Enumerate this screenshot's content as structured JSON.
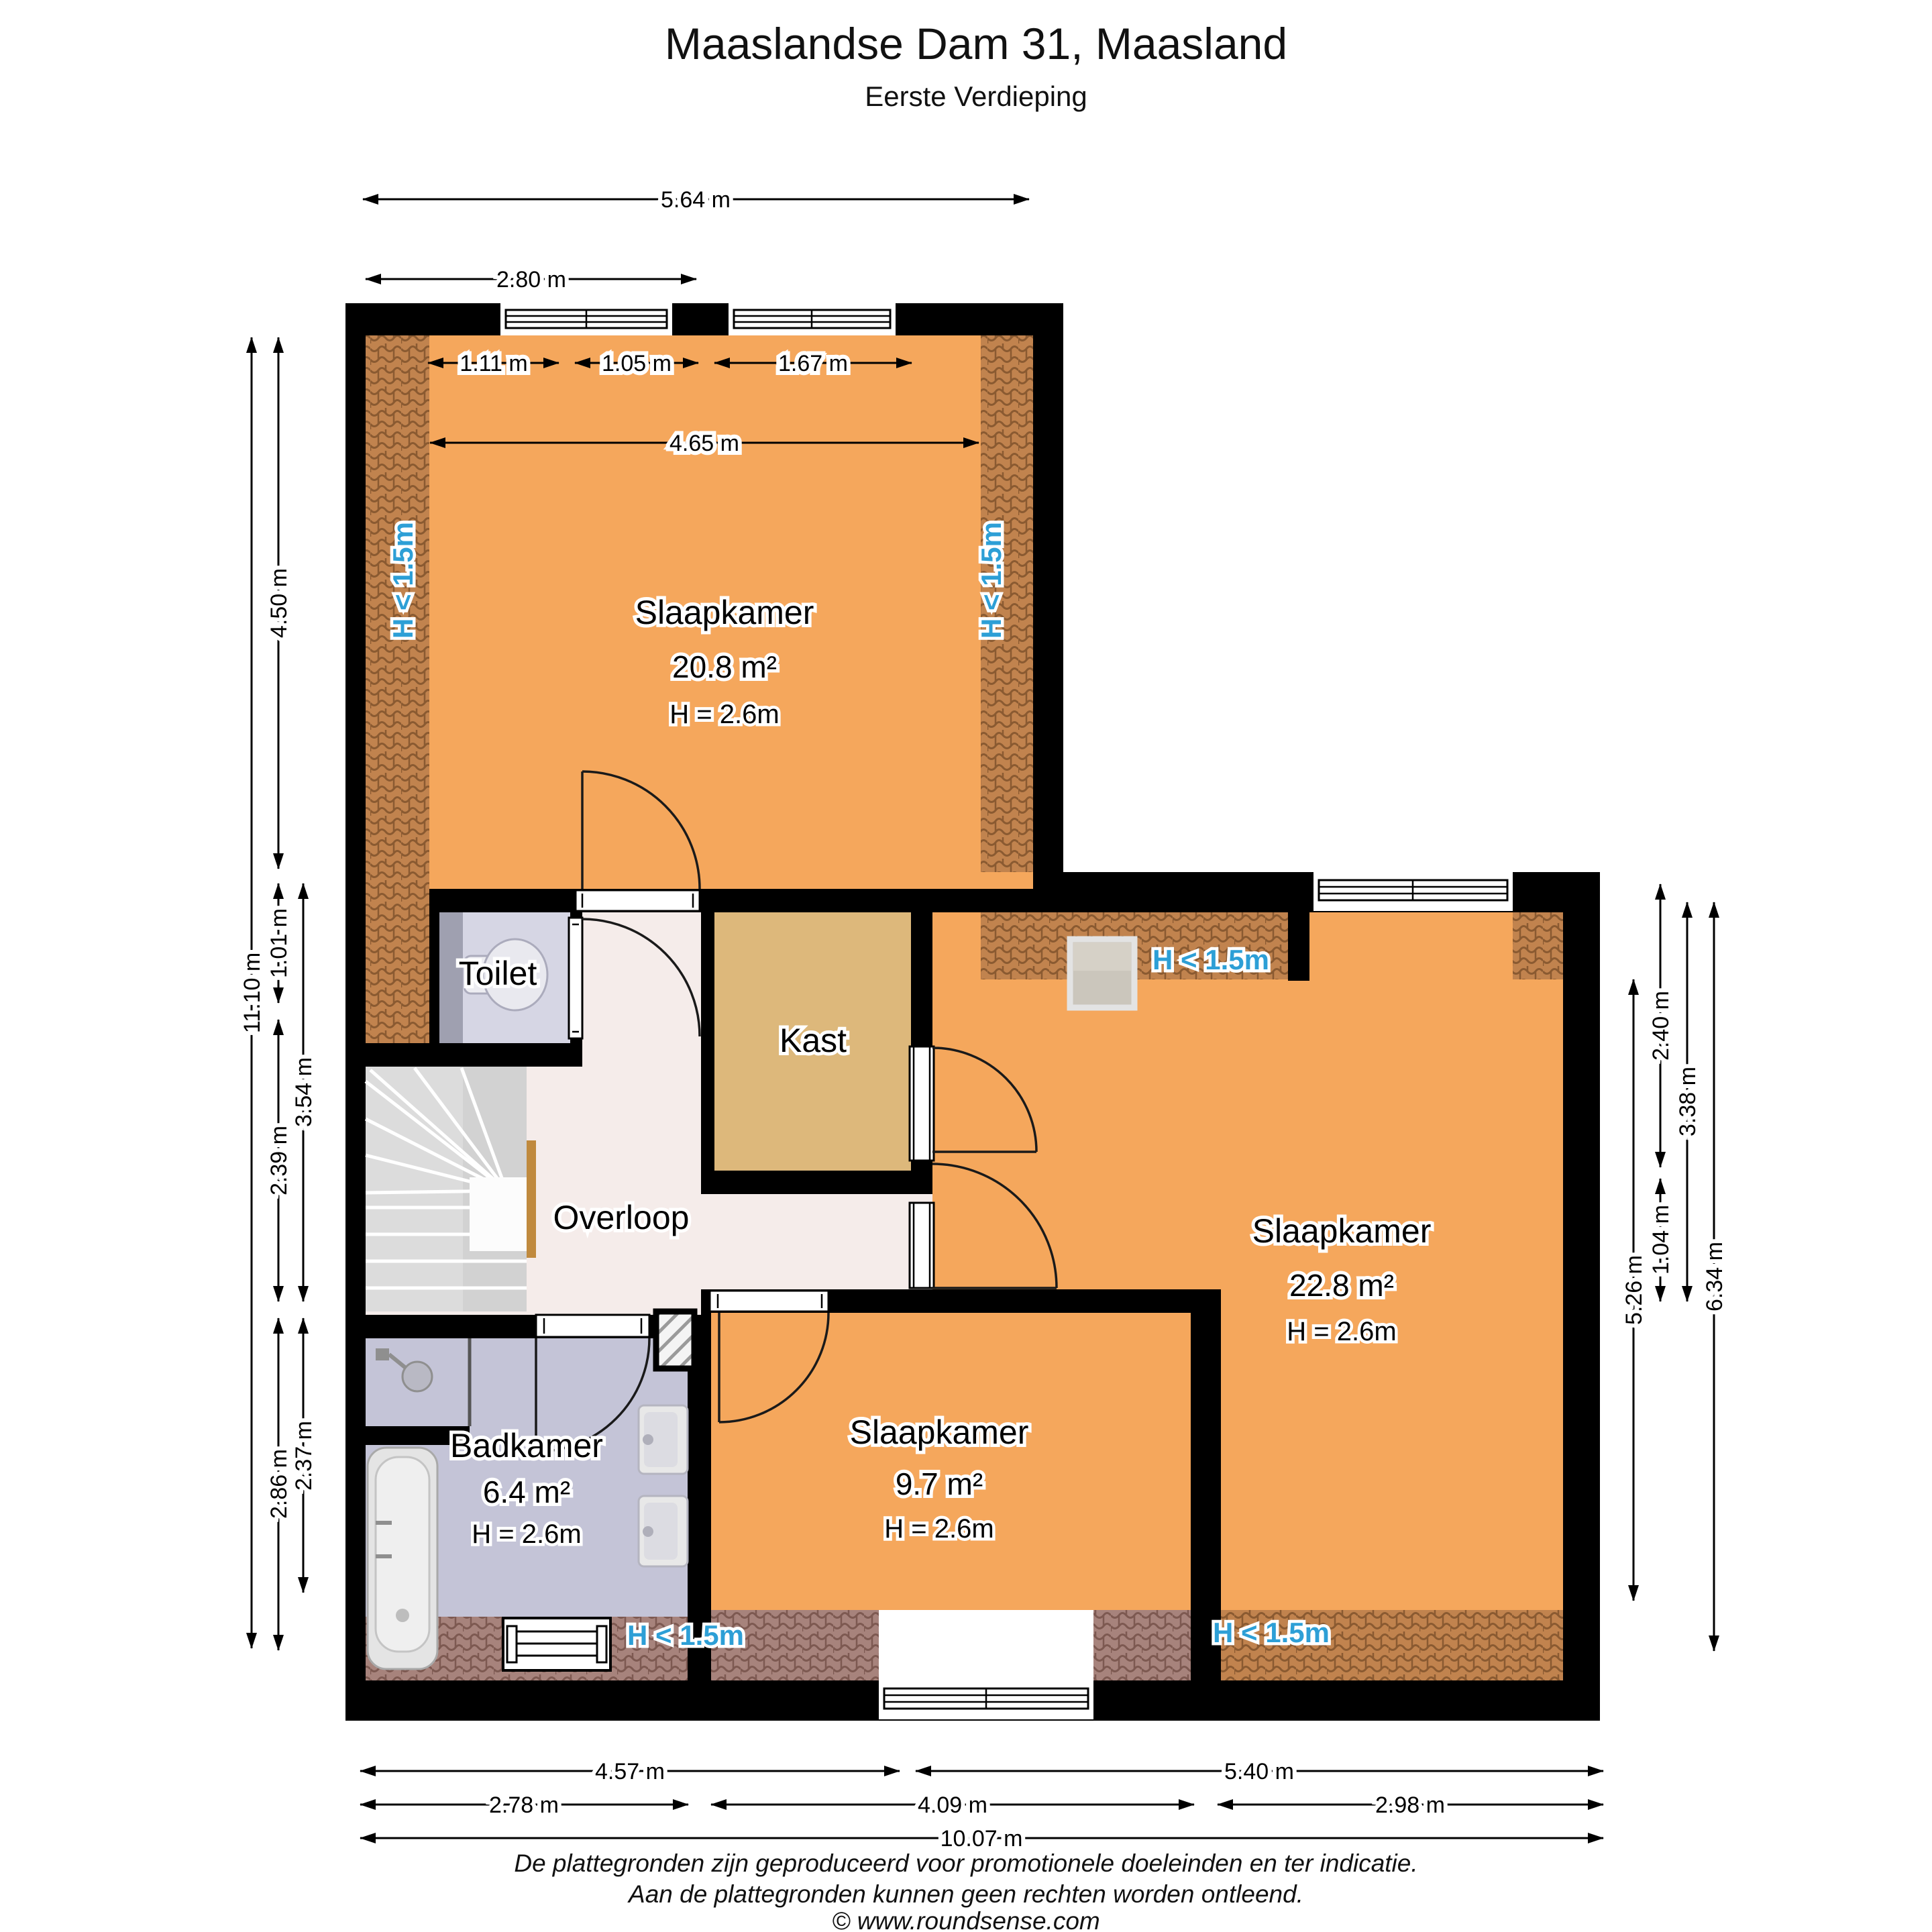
{
  "title": "Maaslandse Dam 31, Maasland",
  "subtitle": "Eerste Verdieping",
  "labels": {
    "low_clearance": "H < 1.5m"
  },
  "rooms": {
    "slaapkamer_1": {
      "name": "Slaapkamer",
      "area": "20.8 m²",
      "height": "H = 2.6m"
    },
    "slaapkamer_2": {
      "name": "Slaapkamer",
      "area": "22.8 m²",
      "height": "H = 2.6m"
    },
    "slaapkamer_3": {
      "name": "Slaapkamer",
      "area": "9.7 m²",
      "height": "H = 2.6m"
    },
    "badkamer": {
      "name": "Badkamer",
      "area": "6.4 m²",
      "height": "H = 2.6m"
    },
    "toilet": {
      "name": "Toilet"
    },
    "kast": {
      "name": "Kast"
    },
    "overloop": {
      "name": "Overloop"
    }
  },
  "dimensions": {
    "top": [
      "5.64 m",
      "2.80 m",
      "1.11 m",
      "1.05 m",
      "1.67 m",
      "4.65 m"
    ],
    "left": [
      "11.10 m",
      "4.50 m",
      "1.01 m",
      "3.54 m",
      "2.39 m",
      "2.86 m",
      "2.37 m"
    ],
    "right": [
      "5.26 m",
      "2.40 m",
      "1.04 m",
      "3.38 m",
      "6.34 m"
    ],
    "bottom": [
      "4.57 m",
      "5.40 m",
      "2.78 m",
      "4.09 m",
      "2.98 m",
      "10.07 m"
    ]
  },
  "footer": {
    "line1": "De plattegronden zijn geproduceerd voor promotionele doeleinden en ter indicatie.",
    "line2": "Aan de plattegronden kunnen geen rechten worden ontleend.",
    "line3": "© www.roundsense.com"
  },
  "colors": {
    "wall": "#000000",
    "bedroom_orange": "#F5A75C",
    "closet_tan": "#DDB87B",
    "landing_pink": "#F5ECEA",
    "bathroom_lavender": "#C4C4D7",
    "toilet_lavender": "#D6D6E4",
    "roof_tile_warm": "#C1834E",
    "roof_tile_dusty": "#A7837C",
    "low_clearance_text": "#2D9FD6",
    "stairs_gray": "#DCDCDC"
  }
}
